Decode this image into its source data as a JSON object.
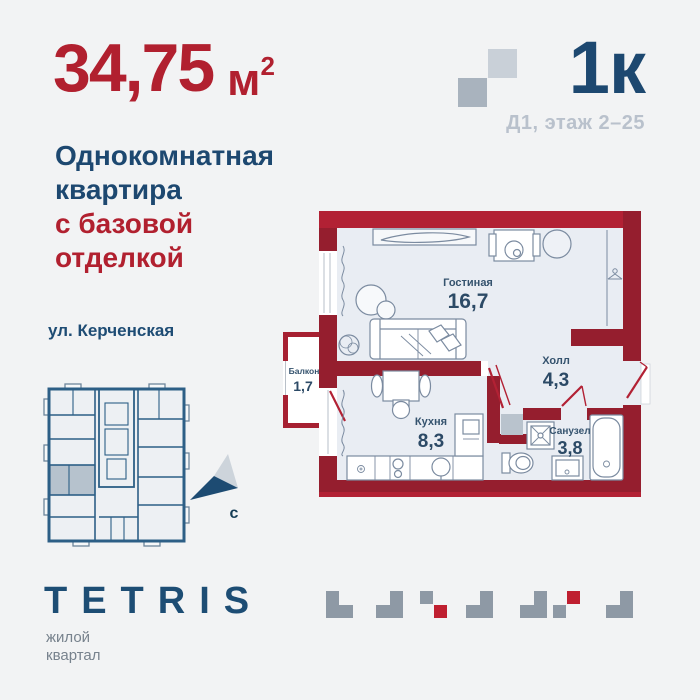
{
  "colors": {
    "background": "#f2f3f4",
    "accent_red": "#b1202f",
    "brand_blue": "#1d4870",
    "muted_gray": "#b9c1cc",
    "wall_red_dark": "#951e2e",
    "wall_red_bright": "#b22134",
    "mini_plan_blue": "#2d5f86",
    "highlight_unit_gray": "#b6c2cd",
    "tetris_gray": "#8e99a5",
    "tetris_red": "#bf1f30"
  },
  "header": {
    "area_value": "34,75",
    "area_unit": "м",
    "area_sup": "2",
    "title_lines": [
      "Однокомнатная",
      "квартира"
    ],
    "accent_lines": [
      "с базовой",
      "отделкой"
    ],
    "plan_type": "1к",
    "building_floor": "Д1, этаж 2–25"
  },
  "location": {
    "street": "ул. Керченская",
    "compass_label": "с"
  },
  "apartment_plan": {
    "rooms": [
      {
        "name": "Гостиная",
        "area": "16,7"
      },
      {
        "name": "Холл",
        "area": "4,3"
      },
      {
        "name": "Кухня",
        "area": "8,3"
      },
      {
        "name": "Санузел",
        "area": "3,8"
      },
      {
        "name": "Балкон",
        "area": "1,7"
      }
    ]
  },
  "footer": {
    "brand": "TETRIS",
    "tagline_lines": [
      "жилой",
      "квартал"
    ]
  }
}
